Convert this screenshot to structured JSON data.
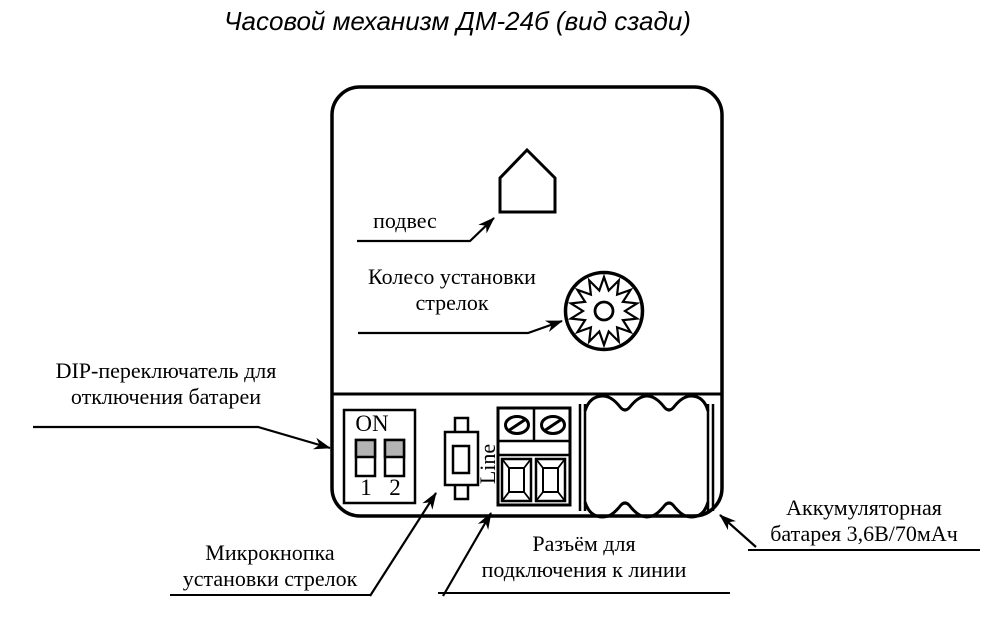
{
  "title": "Часовой механизм ДМ-24б (вид сзади)",
  "colors": {
    "ink": "#000000",
    "background": "#ffffff",
    "switch_fill": "#b3b3b3"
  },
  "callouts": {
    "hanger": {
      "label": "подвес"
    },
    "wheel": {
      "line1": "Колесо установки",
      "line2": "стрелок"
    },
    "dip": {
      "line1": "DIP-переключатель для",
      "line2": "отключения батареи"
    },
    "button": {
      "line1": "Микрокнопка",
      "line2": "установки стрелок"
    },
    "connector": {
      "line1": "Разъём для",
      "line2": "подключения к линии"
    },
    "battery": {
      "line1": "Аккумуляторная",
      "line2": "батарея 3,6В/70мАч"
    }
  },
  "dip_switch": {
    "on": "ON",
    "pos1": "1",
    "pos2": "2"
  },
  "connector": {
    "line": "Line"
  }
}
